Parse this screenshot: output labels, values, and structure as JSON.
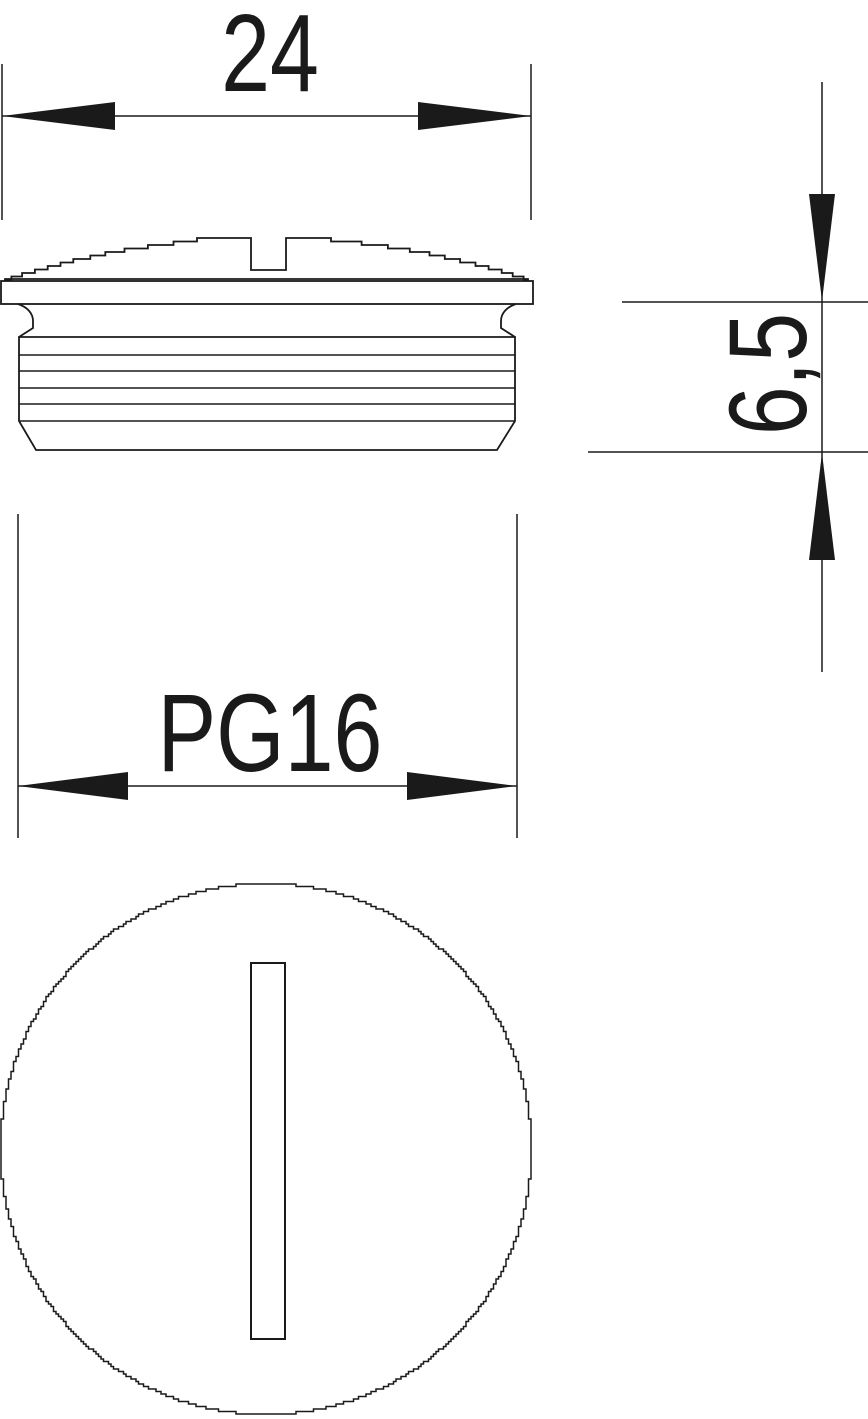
{
  "drawing": {
    "type": "technical-dimension-drawing",
    "views": [
      "side-elevation",
      "front-view"
    ],
    "dimensions": {
      "width": {
        "label": "24"
      },
      "height": {
        "label": "6,5"
      },
      "thread": {
        "label": "PG16"
      }
    },
    "colors": {
      "line": "#1a1a1a",
      "background": "#ffffff"
    },
    "geometry": {
      "canvas": [
        868,
        1419
      ],
      "top_dim": {
        "ext_x": [
          2,
          531
        ],
        "ext_y": [
          64,
          220
        ],
        "line_y": 116,
        "arrow_len": 113,
        "arrow_hw": 14,
        "label_pos": [
          270,
          91
        ]
      },
      "side_view": {
        "dome": {
          "x0": 5,
          "x1": 528,
          "base_y": 279,
          "top_y": 238,
          "flat": [
            197,
            331
          ],
          "notch": {
            "x": [
              251,
              286
            ],
            "depth_y": 270
          },
          "arc_r": 835,
          "cx": 266.5,
          "step_q": 3.5
        },
        "flange": [
          1,
          281,
          532,
          23
        ],
        "neck_left": "M 18 304 C 27 307 33 313 33 321 L 33 328 L 19 337",
        "neck_right": "M 516 304 C 507 307 501 313 501 321 L 501 328 L 515 337",
        "body": {
          "x": [
            19,
            515
          ],
          "top": 337,
          "chamfer_y": 421,
          "bottom_y": 450,
          "bottom_x": [
            36,
            497
          ],
          "thread_lines": [
            355,
            371,
            388,
            404,
            421
          ]
        }
      },
      "height_dim": {
        "line_x": 822,
        "line_y": [
          82,
          672
        ],
        "ext_upper": {
          "y": 302,
          "x": [
            622,
            868
          ]
        },
        "ext_lower": {
          "y": 452,
          "x": [
            588,
            868
          ]
        },
        "arrow_len": 107,
        "arrow_hw": 13,
        "label_pos": [
          806,
          374
        ]
      },
      "thread_dim": {
        "ext_x": [
          18,
          517
        ],
        "ext_y": [
          514,
          838
        ],
        "line_y": 786,
        "arrow_len": 110,
        "arrow_hw": 14,
        "label_pos": [
          270,
          771
        ]
      },
      "front_view": {
        "center": [
          266,
          1149
        ],
        "radius": 265.5,
        "knurl_q": 2.5,
        "slot": [
          251,
          963,
          34,
          376
        ]
      }
    }
  }
}
